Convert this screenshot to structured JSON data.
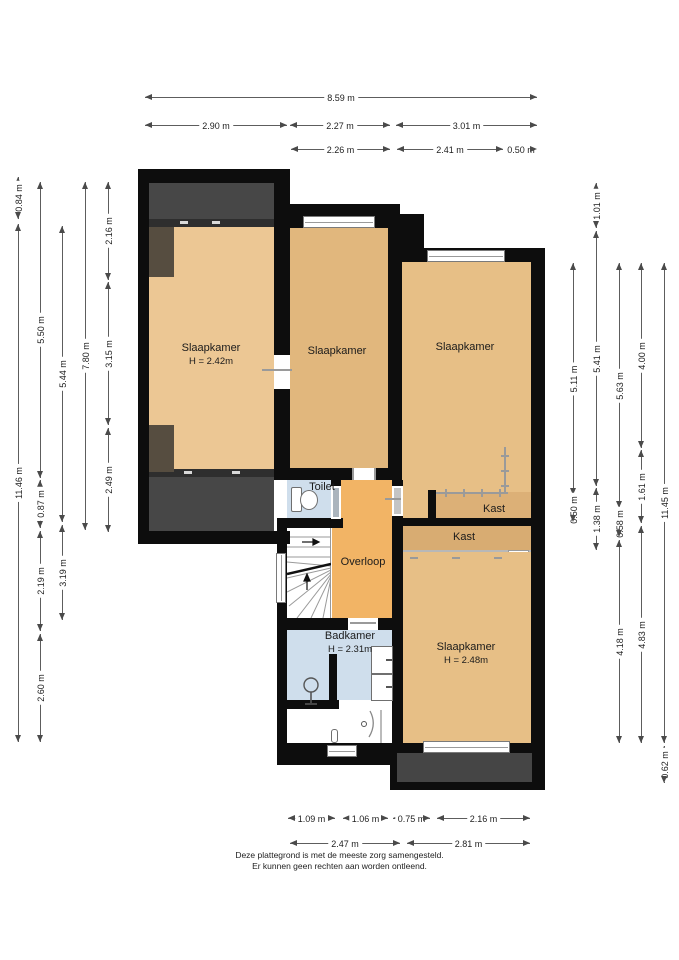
{
  "plan": {
    "type": "floor-plan",
    "floor": "verdieping",
    "colors": {
      "wall": "#0d0d0d",
      "bedroom_left": "#ecc794",
      "bedroom_mid": "#e1b77d",
      "bedroom_right": "#e7bf86",
      "closet": "#d9ae74",
      "landing": "#f2b465",
      "wet_room": "#cfdeec",
      "roof_area": "#474747",
      "dormer": "#564d40",
      "dimension_line": "#5d5d5d"
    }
  },
  "rooms": [
    {
      "label": "Slaapkamer",
      "sub": "H = 2.42m",
      "x": 211,
      "y": 355
    },
    {
      "label": "Slaapkamer",
      "sub": "",
      "x": 337,
      "y": 352
    },
    {
      "label": "Slaapkamer",
      "sub": "",
      "x": 465,
      "y": 348
    },
    {
      "label": "Toilet",
      "sub": "",
      "x": 322,
      "y": 488
    },
    {
      "label": "Kast",
      "sub": "",
      "x": 494,
      "y": 510
    },
    {
      "label": "Kast",
      "sub": "",
      "x": 464,
      "y": 538
    },
    {
      "label": "Overloop",
      "sub": "",
      "x": 363,
      "y": 563
    },
    {
      "label": "Badkamer",
      "sub": "H = 2.31m",
      "x": 350,
      "y": 643
    },
    {
      "label": "Slaapkamer",
      "sub": "H = 2.48m",
      "x": 466,
      "y": 654
    }
  ],
  "dimensions": {
    "top": [
      {
        "label": "8.59 m",
        "x": 145,
        "y": 97,
        "len": 392
      },
      {
        "label": "2.90 m",
        "x": 145,
        "y": 125,
        "len": 142
      },
      {
        "label": "2.27 m",
        "x": 290,
        "y": 125,
        "len": 100
      },
      {
        "label": "3.01 m",
        "x": 396,
        "y": 125,
        "len": 141
      },
      {
        "label": "2.26 m",
        "x": 291,
        "y": 149,
        "len": 99
      },
      {
        "label": "2.41 m",
        "x": 397,
        "y": 149,
        "len": 106
      },
      {
        "label": "0.50 m",
        "x": 505,
        "y": 149,
        "len": 32
      }
    ],
    "bottom": [
      {
        "label": "1.09 m",
        "x": 288,
        "y": 818,
        "len": 47
      },
      {
        "label": "1.06 m",
        "x": 343,
        "y": 818,
        "len": 45
      },
      {
        "label": "0.75 m",
        "x": 393,
        "y": 818,
        "len": 37
      },
      {
        "label": "2.16 m",
        "x": 437,
        "y": 818,
        "len": 93
      },
      {
        "label": "2.47 m",
        "x": 290,
        "y": 843,
        "len": 110
      },
      {
        "label": "2.81 m",
        "x": 407,
        "y": 843,
        "len": 123
      }
    ],
    "left": [
      {
        "label": "0.84 m",
        "x": 18,
        "y": 177,
        "len": 42
      },
      {
        "label": "11.46 m",
        "x": 18,
        "y": 224,
        "len": 518
      },
      {
        "label": "5.50 m",
        "x": 40,
        "y": 182,
        "len": 296
      },
      {
        "label": "0.87 m",
        "x": 40,
        "y": 480,
        "len": 48
      },
      {
        "label": "2.19 m",
        "x": 40,
        "y": 531,
        "len": 100
      },
      {
        "label": "2.60 m",
        "x": 40,
        "y": 634,
        "len": 108
      },
      {
        "label": "5.44 m",
        "x": 62,
        "y": 226,
        "len": 296
      },
      {
        "label": "3.19 m",
        "x": 62,
        "y": 525,
        "len": 95
      },
      {
        "label": "7.80 m",
        "x": 85,
        "y": 182,
        "len": 348
      },
      {
        "label": "2.16 m",
        "x": 108,
        "y": 182,
        "len": 98
      },
      {
        "label": "3.15 m",
        "x": 108,
        "y": 282,
        "len": 143
      },
      {
        "label": "2.49 m",
        "x": 108,
        "y": 428,
        "len": 104
      }
    ],
    "right": [
      {
        "label": "5.11 m",
        "x": 573,
        "y": 263,
        "len": 232
      },
      {
        "label": "0.50 m",
        "x": 573,
        "y": 497,
        "len": 25
      },
      {
        "label": "1.01 m",
        "x": 596,
        "y": 183,
        "len": 45
      },
      {
        "label": "5.41 m",
        "x": 596,
        "y": 231,
        "len": 255
      },
      {
        "label": "1.38 m",
        "x": 596,
        "y": 488,
        "len": 62
      },
      {
        "label": "5.63 m",
        "x": 619,
        "y": 263,
        "len": 245
      },
      {
        "label": "0.58 m",
        "x": 619,
        "y": 510,
        "len": 27
      },
      {
        "label": "4.18 m",
        "x": 619,
        "y": 540,
        "len": 203
      },
      {
        "label": "4.00 m",
        "x": 641,
        "y": 263,
        "len": 185
      },
      {
        "label": "1.61 m",
        "x": 641,
        "y": 450,
        "len": 73
      },
      {
        "label": "4.83 m",
        "x": 641,
        "y": 526,
        "len": 217
      },
      {
        "label": "11.45 m",
        "x": 664,
        "y": 263,
        "len": 480
      },
      {
        "label": "0.62 m",
        "x": 664,
        "y": 746,
        "len": 37
      }
    ]
  },
  "footer": {
    "line1": "Deze plattegrond is met de meeste zorg samengesteld.",
    "line2": "Er kunnen geen rechten aan worden ontleend."
  }
}
